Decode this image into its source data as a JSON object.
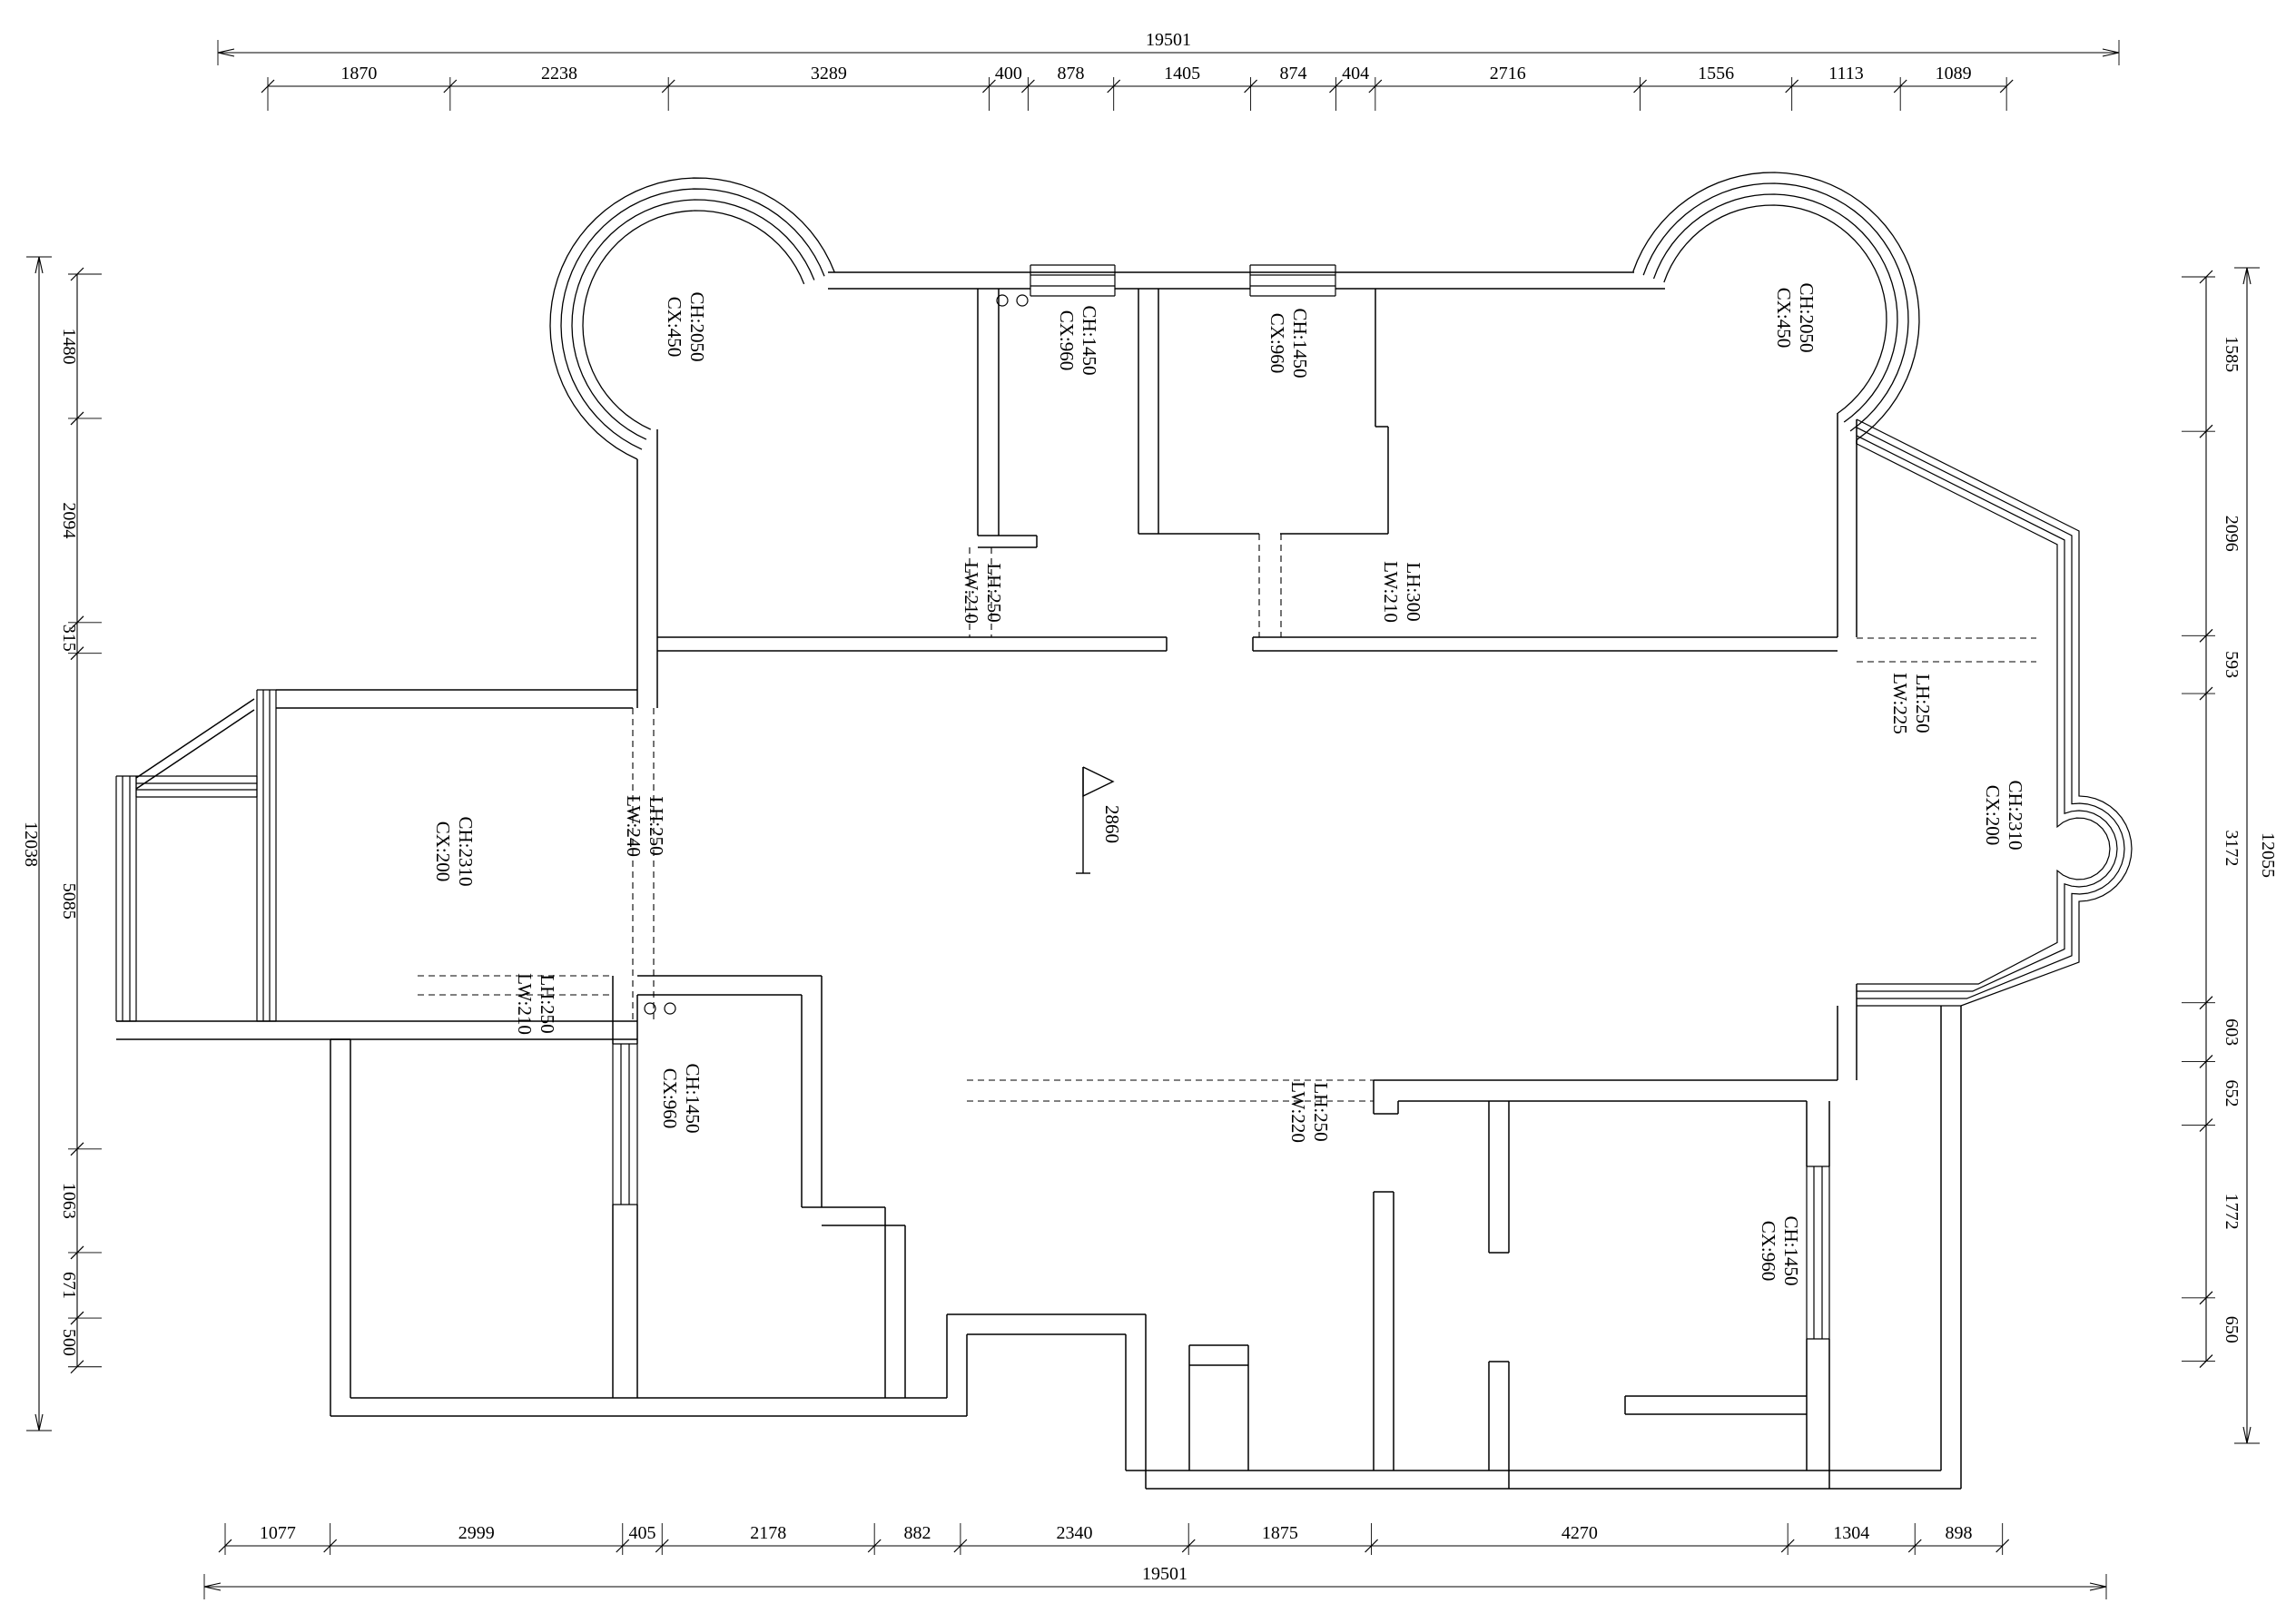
{
  "drawing": {
    "colors": {
      "line": "#000000",
      "background": "#ffffff",
      "text": "#000000"
    },
    "dim_top": {
      "total": "19501",
      "segments": [
        "1870",
        "2238",
        "3289",
        "400",
        "878",
        "1405",
        "874",
        "404",
        "2716",
        "1556",
        "1113",
        "1089"
      ]
    },
    "dim_bottom": {
      "total": "19501",
      "segments": [
        "1077",
        "2999",
        "405",
        "2178",
        "882",
        "2340",
        "1875",
        "4270",
        "1304",
        "898"
      ]
    },
    "dim_left": {
      "total": "12038",
      "segments": [
        "1480",
        "2094",
        "315",
        "5085",
        "1063",
        "671",
        "500"
      ]
    },
    "dim_right": {
      "total": "12055",
      "segments": [
        "1585",
        "2096",
        "593",
        "3172",
        "603",
        "652",
        "1772",
        "650"
      ]
    },
    "elevation": {
      "value": "2860"
    },
    "labels": [
      {
        "id": "bay-window-top-left",
        "lines": [
          "CH:2050",
          "CX:450"
        ]
      },
      {
        "id": "window-top-1",
        "lines": [
          "CH:1450",
          "CX:960"
        ]
      },
      {
        "id": "window-top-2",
        "lines": [
          "CH:1450",
          "CX:960"
        ]
      },
      {
        "id": "bay-window-top-right",
        "lines": [
          "CH:2050",
          "CX:450"
        ]
      },
      {
        "id": "beam-upper-left",
        "lines": [
          "LH:250",
          "LW:210"
        ]
      },
      {
        "id": "beam-upper-right",
        "lines": [
          "LH:300",
          "LW:210"
        ]
      },
      {
        "id": "beam-right-bay",
        "lines": [
          "LH:250",
          "LW:225"
        ]
      },
      {
        "id": "bay-window-right",
        "lines": [
          "CH:2310",
          "CX:200"
        ]
      },
      {
        "id": "window-left-balcony",
        "lines": [
          "CH:2310",
          "CX:200"
        ]
      },
      {
        "id": "beam-living-left",
        "lines": [
          "LH:250",
          "LW:240"
        ]
      },
      {
        "id": "beam-lower-left",
        "lines": [
          "LH:250",
          "LW:210"
        ]
      },
      {
        "id": "window-lower-left-room",
        "lines": [
          "CH:1450",
          "CX:960"
        ]
      },
      {
        "id": "beam-lower-middle",
        "lines": [
          "LH:250",
          "LW:220"
        ]
      },
      {
        "id": "window-lower-right-room",
        "lines": [
          "CH:1450",
          "CX:960"
        ]
      }
    ]
  }
}
